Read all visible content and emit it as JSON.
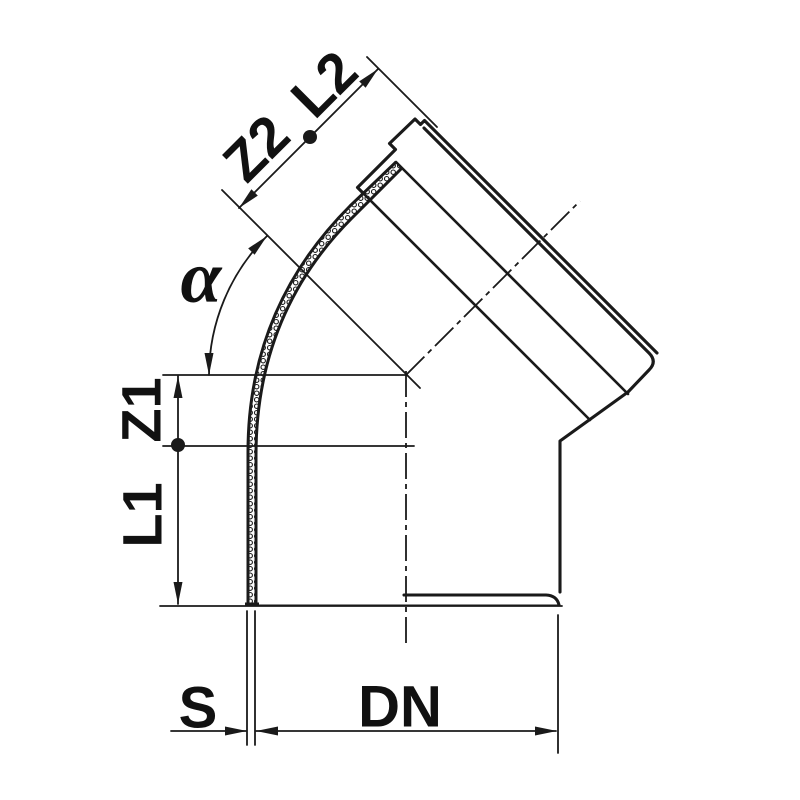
{
  "diagram": {
    "subject": "45-degree pipe bend (socket elbow) cross-section with dimension annotations",
    "labels": {
      "z2": "Z2",
      "l2": "L2",
      "alpha": "α",
      "z1": "Z1",
      "l1": "L1",
      "s": "S",
      "dn": "DN"
    },
    "colors": {
      "line": "#1a1a1a",
      "background": "#ffffff"
    }
  }
}
